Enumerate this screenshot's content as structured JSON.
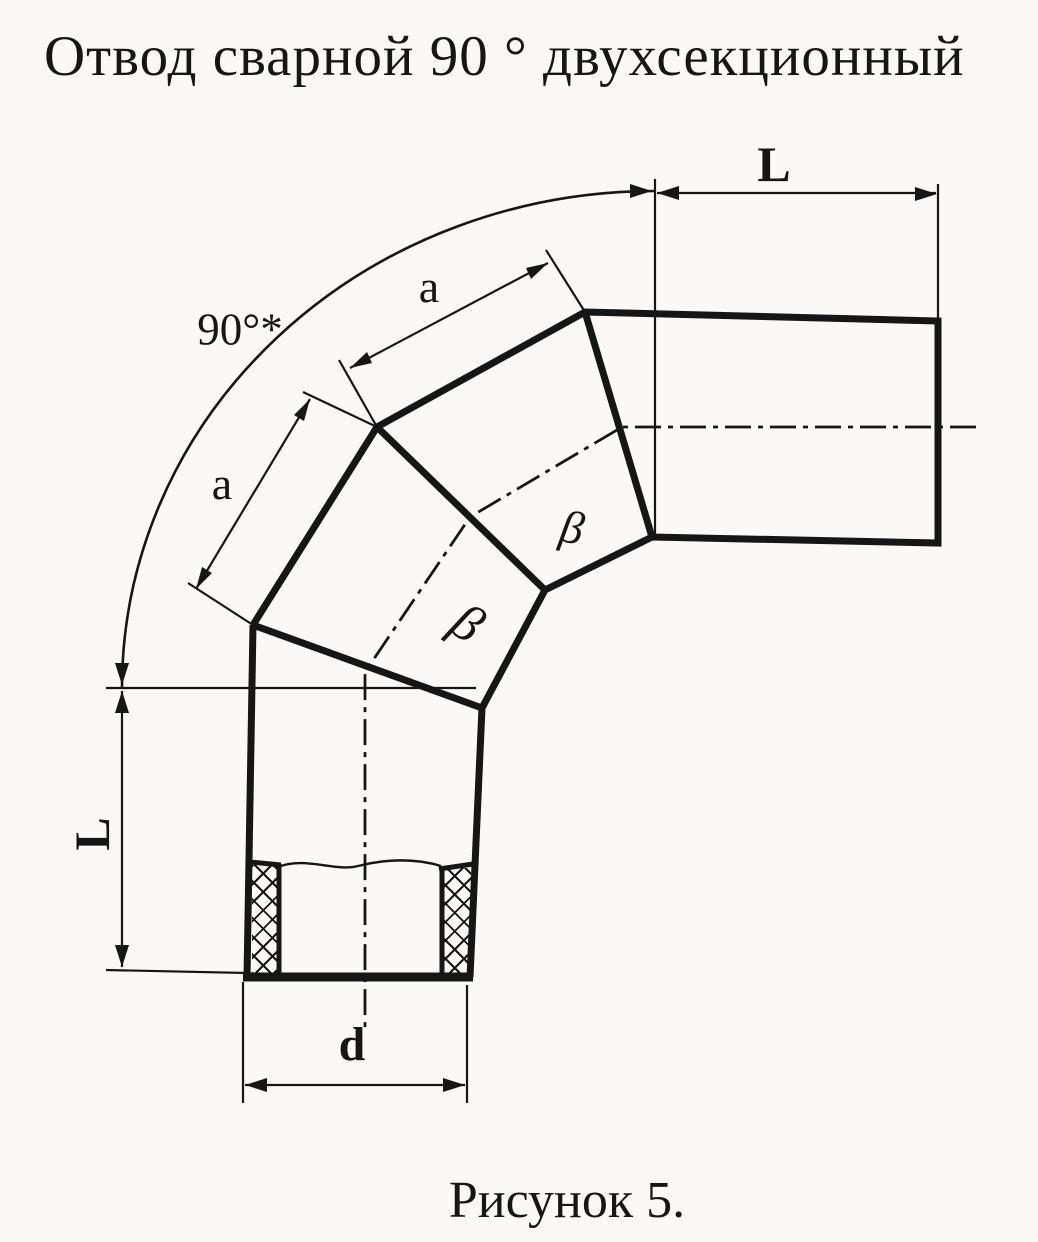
{
  "title": "Отвод сварной 90 ° двухсекционный",
  "caption": "Рисунок 5.",
  "dimensions": {
    "tangent_length_top": "L",
    "tangent_length_left": "L",
    "segment_length_upper": "a",
    "segment_length_lower": "a",
    "bend_angle": "90°*",
    "miter_angle_upper": "β",
    "miter_angle_lower": "β",
    "diameter": "d"
  },
  "drawing_description": "Welded 90° two-section pipe elbow: vertical inlet pipe with cross-hatched wall section, two mitered middle segments joined by weld seams, horizontal outlet pipe; dimension L on both straight tangents, segment lengths a, bore diameter d, overall bend angle 90°*, weld miter angles β",
  "colors": {
    "ink": "#161616",
    "paper": "#faf9f7"
  }
}
